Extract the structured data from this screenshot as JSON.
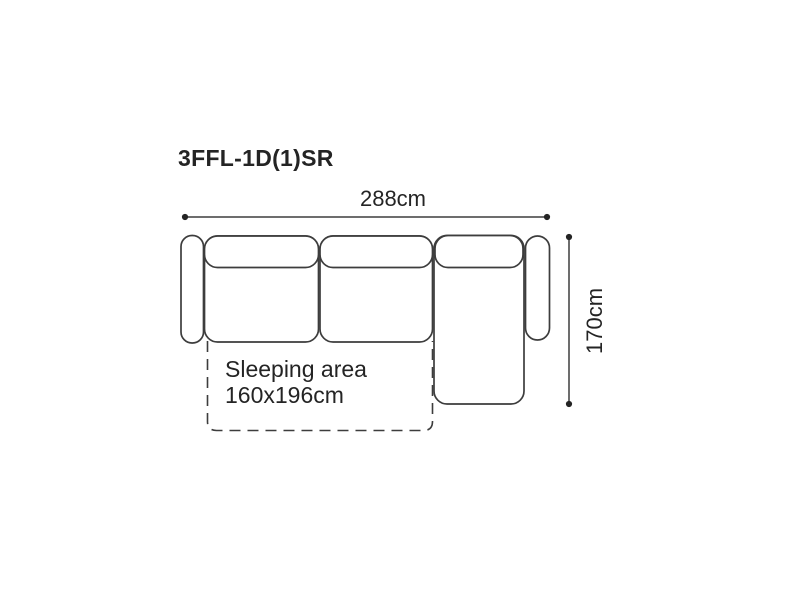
{
  "diagram": {
    "model_code": "3FFL-1D(1)SR",
    "width_label": "288cm",
    "depth_label": "170cm",
    "sleeping_area": {
      "title": "Sleeping area",
      "dimensions": "160x196cm"
    },
    "colors": {
      "background": "#ffffff",
      "line": "#3d3d3d",
      "text": "#242424"
    }
  }
}
